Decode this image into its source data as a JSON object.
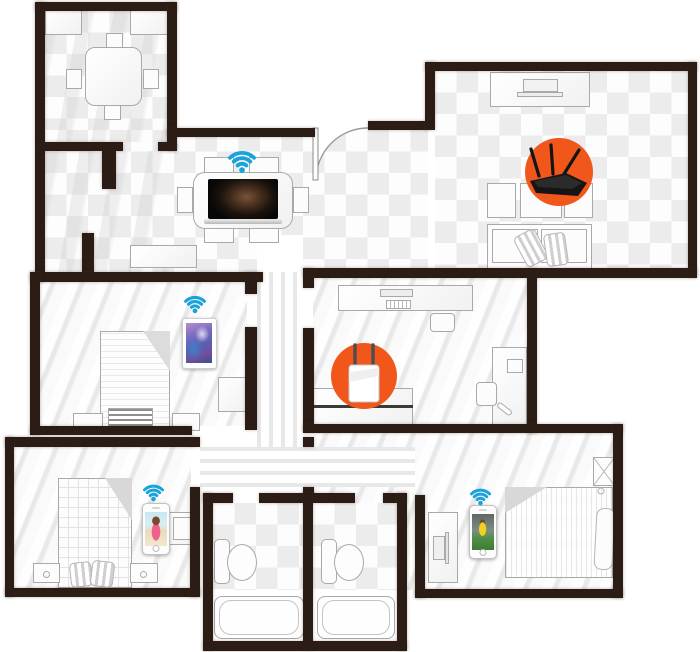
{
  "floorplan": {
    "type": "wifi-coverage-floor-plan",
    "colors": {
      "wall": "#2b1d15",
      "hotspot_orange": "#f1571b",
      "wifi_blue": "#18a3dc",
      "checker_gray": "#ececec",
      "floor_white": "#f3f3f3"
    },
    "rooms": [
      {
        "id": "kitchen",
        "furniture": [
          "counter",
          "counter",
          "square-table",
          "chairs-x4"
        ]
      },
      {
        "id": "dining-area",
        "furniture": [
          "dining-table",
          "chairs-x6",
          "sideboard"
        ],
        "device": "laptop"
      },
      {
        "id": "living-room",
        "furniture": [
          "tv-stand",
          "tv",
          "armchairs-x3",
          "sofa",
          "cushions"
        ],
        "device": "wifi-router"
      },
      {
        "id": "office",
        "furniture": [
          "desk",
          "monitor",
          "keyboard",
          "office-chair",
          "sideboard",
          "side-desk",
          "side-chair"
        ],
        "device": "range-extender"
      },
      {
        "id": "bedroom-left",
        "furniture": [
          "bed",
          "nightstand",
          "nightstand",
          "blanket-stack",
          "desk"
        ],
        "device": "tablet"
      },
      {
        "id": "bedroom-bottom-left",
        "furniture": [
          "bed",
          "pillows",
          "nightstand",
          "nightstand",
          "side-table"
        ],
        "device": "smartphone"
      },
      {
        "id": "bedroom-bottom-right",
        "furniture": [
          "bed",
          "pillow",
          "wardrobe",
          "tv-stand"
        ],
        "device": "smartphone"
      },
      {
        "id": "bathroom-1",
        "furniture": [
          "toilet",
          "bathtub"
        ]
      },
      {
        "id": "bathroom-2",
        "furniture": [
          "toilet",
          "bathtub"
        ]
      },
      {
        "id": "hallway",
        "furniture": []
      }
    ],
    "devices": [
      {
        "id": "wifi-router",
        "marker": "orange-circle",
        "room": "living-room"
      },
      {
        "id": "range-extender",
        "marker": "orange-circle",
        "room": "office"
      },
      {
        "id": "laptop",
        "signal": "wifi",
        "room": "dining-area"
      },
      {
        "id": "tablet",
        "signal": "wifi",
        "room": "bedroom-left"
      },
      {
        "id": "smartphone-beach",
        "signal": "wifi",
        "room": "bedroom-bottom-left"
      },
      {
        "id": "smartphone-soccer",
        "signal": "wifi",
        "room": "bedroom-bottom-right"
      }
    ],
    "wifi_icon_count": 4,
    "door_count": 1
  }
}
